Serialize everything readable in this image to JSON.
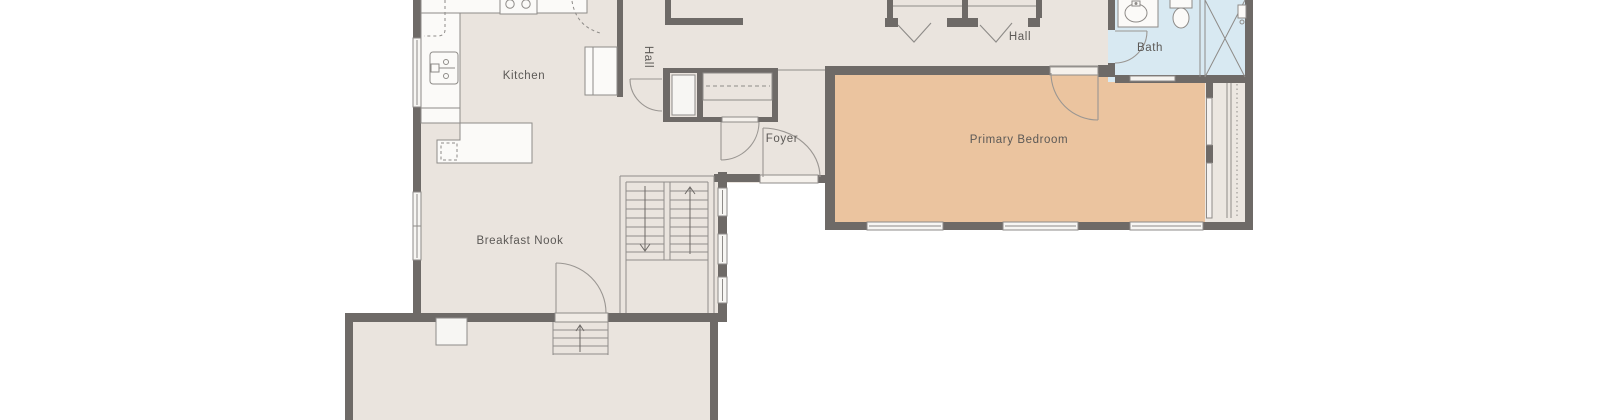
{
  "page": {
    "type": "architectural-floor-plan",
    "background": "#FFFFFF"
  },
  "colors": {
    "floor": "#EAE4DE",
    "bedroom_floor": "#EBC49F",
    "bath_floor": "#D8E9F2",
    "closet_floor": "#ECE7E1",
    "wall": "#6E6A67",
    "fixture_fill": "#FBFAF8",
    "window_fill": "#F7F6F3",
    "line": "#8E8B88",
    "door_line": "#9A9692",
    "label_text": "#5C5956"
  },
  "rooms": {
    "kitchen": {
      "label": "Kitchen"
    },
    "hall_corridor": {
      "label": "Hall"
    },
    "hall_upper": {
      "label": "Hall"
    },
    "foyer": {
      "label": "Foyer"
    },
    "bath": {
      "label": "Bath"
    },
    "primary_bedroom": {
      "label": "Primary Bedroom"
    },
    "breakfast_nook": {
      "label": "Breakfast Nook"
    }
  },
  "icons": [
    "stove-icon",
    "kitchen-sink-icon",
    "bath-sink-icon",
    "toilet-icon",
    "shower-icon",
    "hanger-rod-icon",
    "stair-up-arrow-icon",
    "stair-down-arrow-icon"
  ]
}
